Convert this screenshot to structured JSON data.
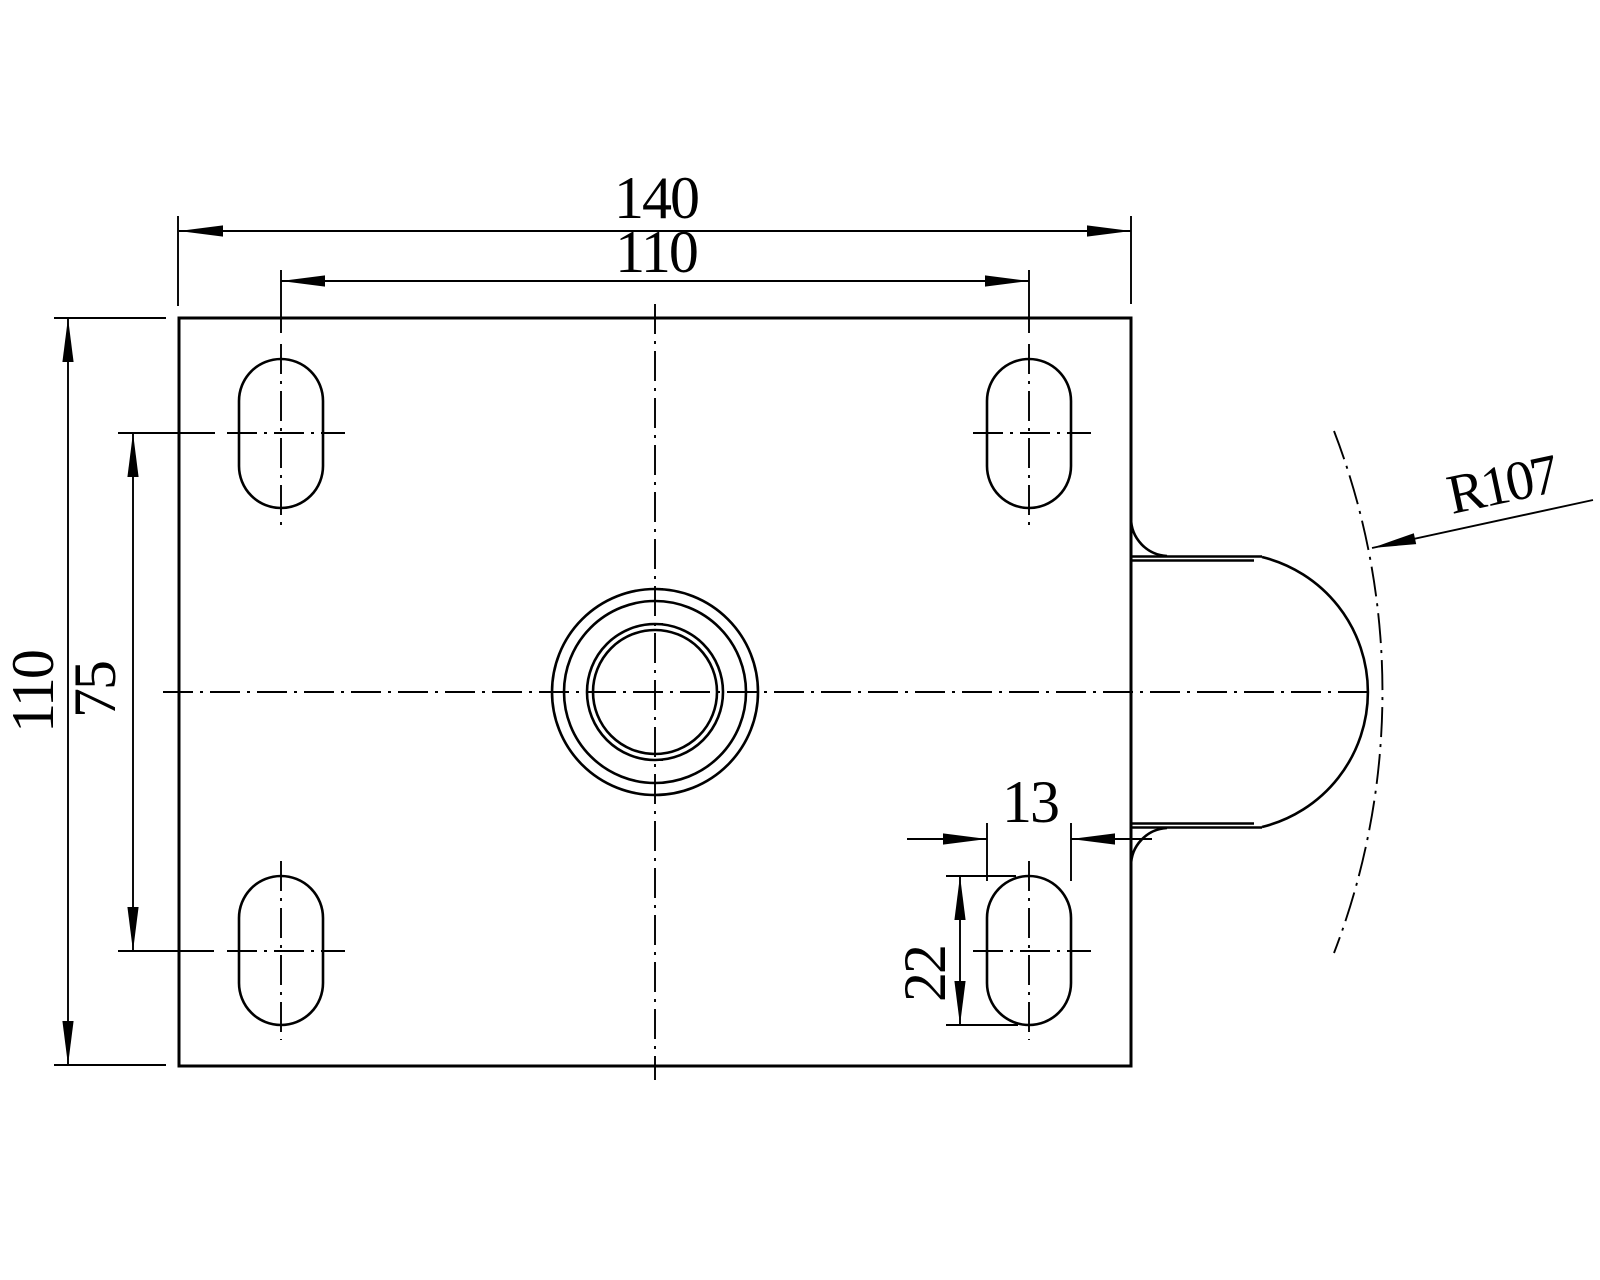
{
  "drawing": {
    "background": "#ffffff",
    "line_color": "#000000",
    "dimensions": {
      "plate_width": "140",
      "bolt_spacing_width": "110",
      "plate_height": "110",
      "bolt_spacing_height": "75",
      "slot_width": "13",
      "slot_length": "22",
      "swivel_radius": "R107"
    }
  }
}
